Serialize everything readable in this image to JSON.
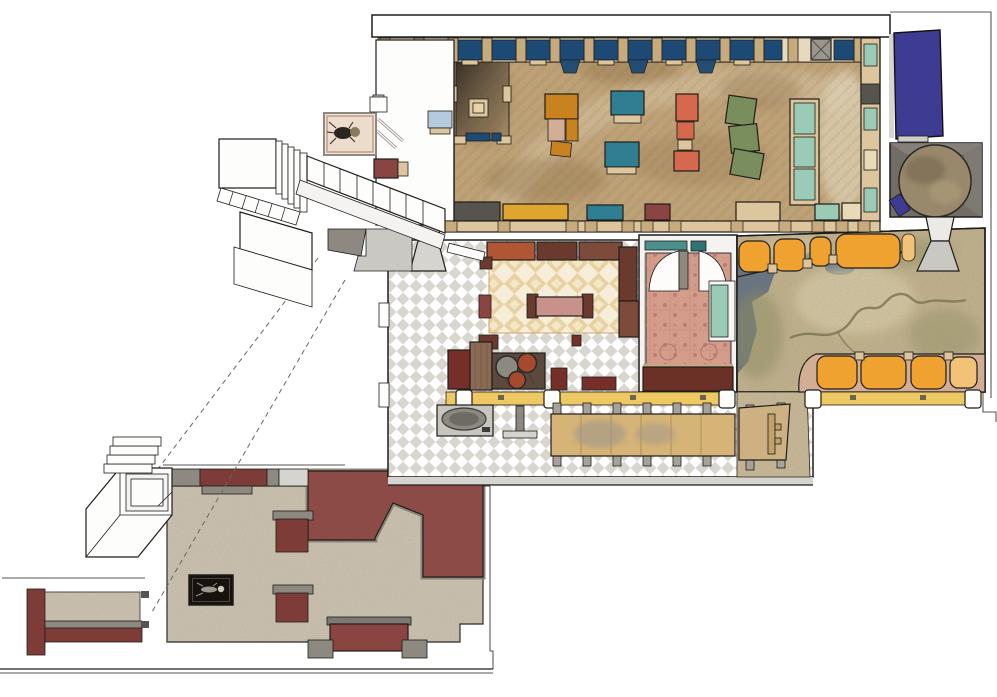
{
  "scene": {
    "type": "isometric-floor-plan",
    "has_text": false,
    "levels": [
      "upper-hall",
      "mid-level",
      "lower-hall"
    ],
    "rooms": [
      "entrance-vestibule",
      "main-hall",
      "stair-tower",
      "round-stair-room",
      "lounge-cafe",
      "rug-room",
      "map-floor-lounge",
      "kitchen-bar",
      "communal-tables",
      "lower-hall",
      "corridor"
    ],
    "furniture": [
      "window-bay-seats",
      "dining-tables",
      "wall-benches",
      "booth-seats",
      "sofas",
      "bar-counter",
      "long-tables",
      "stools",
      "display-case",
      "wash-basin",
      "framed-picture",
      "staircases"
    ]
  },
  "palette": {
    "ink": "#1f1d1a",
    "paper": "#ffffff",
    "wallTan": "#ddc69e",
    "pillarTan": "#c8ab7c",
    "winNavy": "#1d4a75",
    "lightBlue": "#b3cbdd",
    "indigo": "#3e3c92",
    "marble": "#c1a376",
    "marbleDark": "#87683e",
    "marbleLight": "#e6dabd",
    "shadowDark": "#2e2822",
    "tableOrange": "#c8821f",
    "boothOrange": "#efa22f",
    "boothOrangeLight": "#f2c279",
    "teal": "#2f7e91",
    "seafoam": "#9acbb7",
    "salmon": "#d5684d",
    "olive": "#7a8d5c",
    "maroon": "#8a4543",
    "maroonWall": "#7e3c38",
    "maroonPlatform": "#8d4b48",
    "darkRed": "#762f28",
    "rust": "#b05634",
    "sofaBrown": "#6b3a2e",
    "sofaBrown2": "#7d4b39",
    "benchDkBrown": "#6b3026",
    "counterBrown": "#5c493d",
    "benchYellow": "#dfa52f",
    "counterYellow": "#eec862",
    "wood": "#d6b377",
    "woodLight": "#cdb183",
    "pinkTan": "#d3ae97",
    "pinkBench": "#c8928b",
    "orientalRug": "#d49c8b",
    "rugMotif": "#b5746a",
    "rugTanBg": "#f6eed9",
    "rugTanDiamond": "#e8d2a2",
    "checkerBg": "#d9d6d0",
    "terrazzo": "#cfc5b3",
    "mapBase": "#c2b28c",
    "walkway": "#c9ba97",
    "water": "#5c6c7e",
    "mapGreen": "#8d8d60",
    "river": "#7b7552",
    "grayDark": "#57534e",
    "grayMid": "#8d8880",
    "grayLight": "#d6d4cf",
    "grayStair": "#cac8c3",
    "grayRoom": "#716c66",
    "caseBlack": "#17120d",
    "bone": "#cfc9bb",
    "cream": "#e8d9b8",
    "tealDoor": "#4a8f8a"
  }
}
